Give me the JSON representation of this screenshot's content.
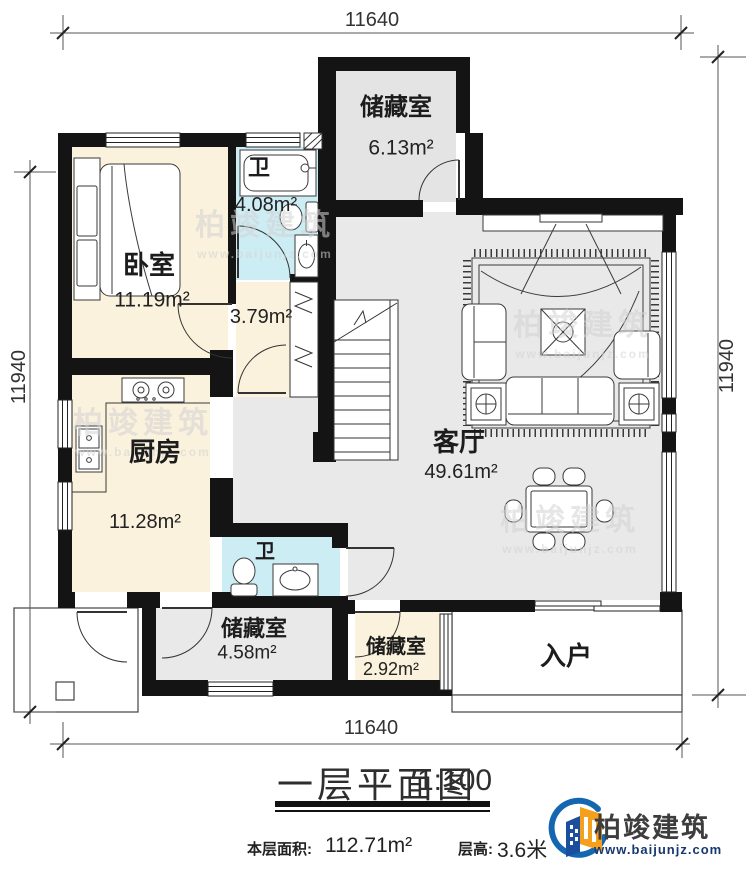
{
  "dimensions": {
    "top": "11640",
    "bottom": "11640",
    "left": "11940",
    "right": "11940"
  },
  "rooms": {
    "storage_top": {
      "name": "储藏室",
      "area": "6.13m²"
    },
    "bedroom": {
      "name": "卧室",
      "area": "11.19m²"
    },
    "bath_top": {
      "name": "卫",
      "area": "4.08m²"
    },
    "hallway": {
      "area": "3.79m²"
    },
    "kitchen": {
      "name": "厨房",
      "area": "11.28m²"
    },
    "bath_bottom": {
      "name": "卫"
    },
    "storage_mid": {
      "name": "储藏室",
      "area": "4.58m²"
    },
    "storage_small": {
      "name": "储藏室",
      "area": "2.92m²"
    },
    "living": {
      "name": "客厅",
      "area": "49.61m²"
    },
    "entry": {
      "name": "入户"
    }
  },
  "title": {
    "text": "一层平面图",
    "scale": "1:100"
  },
  "footer": {
    "floor_area_label": "本层面积:",
    "floor_area_value": "112.71m²",
    "floor_height_label": "层高:",
    "floor_height_value": "3.6米"
  },
  "brand": {
    "name": "柏竣建筑",
    "website": "www.baijunjz.com"
  },
  "watermark": {
    "name": "柏竣建筑",
    "website": "www.baijunjz.com"
  },
  "colors": {
    "wall": "#141414",
    "room_gray": "#e9e9e9",
    "room_cream": "#fbf2dd",
    "room_blue": "#cdedf5",
    "brand_blue": "#16386e",
    "brand_orange": "#f5a01c"
  }
}
